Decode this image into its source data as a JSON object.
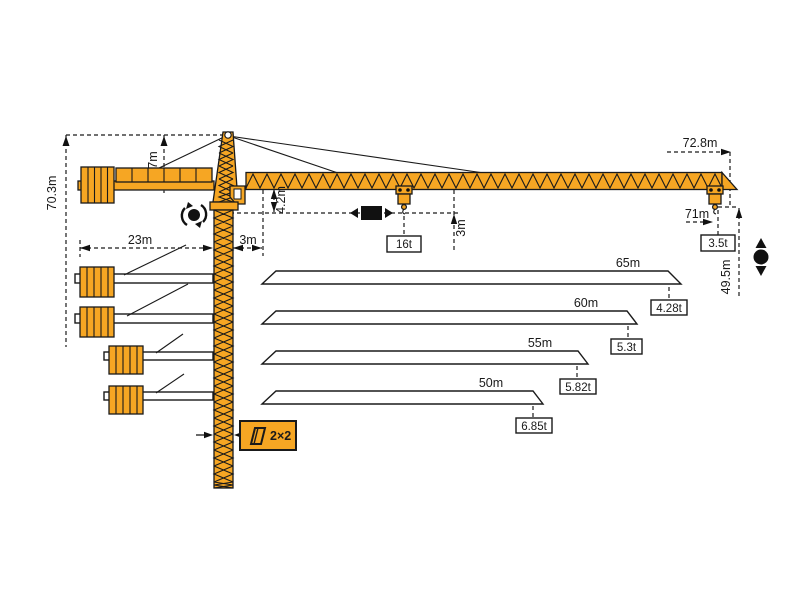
{
  "diagram_type": "tower-crane-dimension-and-load-diagram",
  "colors": {
    "crane_orange": "#F6A623",
    "outline": "#1A1A1A",
    "background": "#FFFFFF"
  },
  "dims": {
    "total_height": "70.3m",
    "tower_head": "7m",
    "counter_jib": "23m",
    "jib_root": "3m",
    "under_jib": "4.2m",
    "hook_drop": "3m",
    "max_radius": "72.8m",
    "tip_hook_radius": "71m",
    "hook_height": "49.5m"
  },
  "loads": {
    "max": "16t",
    "tip": "3.5t"
  },
  "reeving_label": "2×2",
  "load_chart": {
    "rows": [
      {
        "jib_length": "65m",
        "tip_load": "4.28t"
      },
      {
        "jib_length": "60m",
        "tip_load": "5.3t"
      },
      {
        "jib_length": "55m",
        "tip_load": "5.82t"
      },
      {
        "jib_length": "50m",
        "tip_load": "6.85t"
      }
    ]
  },
  "icons": [
    "slewing-rotation-icon",
    "trolley-travel-icon",
    "hook-travel-icon",
    "rope-reeving-icon"
  ],
  "chart_data": {
    "type": "table",
    "title": "Tower crane jib length vs. tip capacity",
    "columns": [
      "jib_length",
      "tip_load"
    ],
    "rows": [
      [
        "65m",
        "4.28t"
      ],
      [
        "60m",
        "5.3t"
      ],
      [
        "55m",
        "5.82t"
      ],
      [
        "50m",
        "6.85t"
      ]
    ],
    "max_capacity": "16t",
    "capacity_at_tip": "3.5t",
    "tip_hook_radius": "71m",
    "max_radius": "72.8m",
    "hook_height_under_hook": "49.5m",
    "total_height": "70.3m",
    "counter_jib_radius": "23m",
    "rope_reeving": "2×2"
  }
}
